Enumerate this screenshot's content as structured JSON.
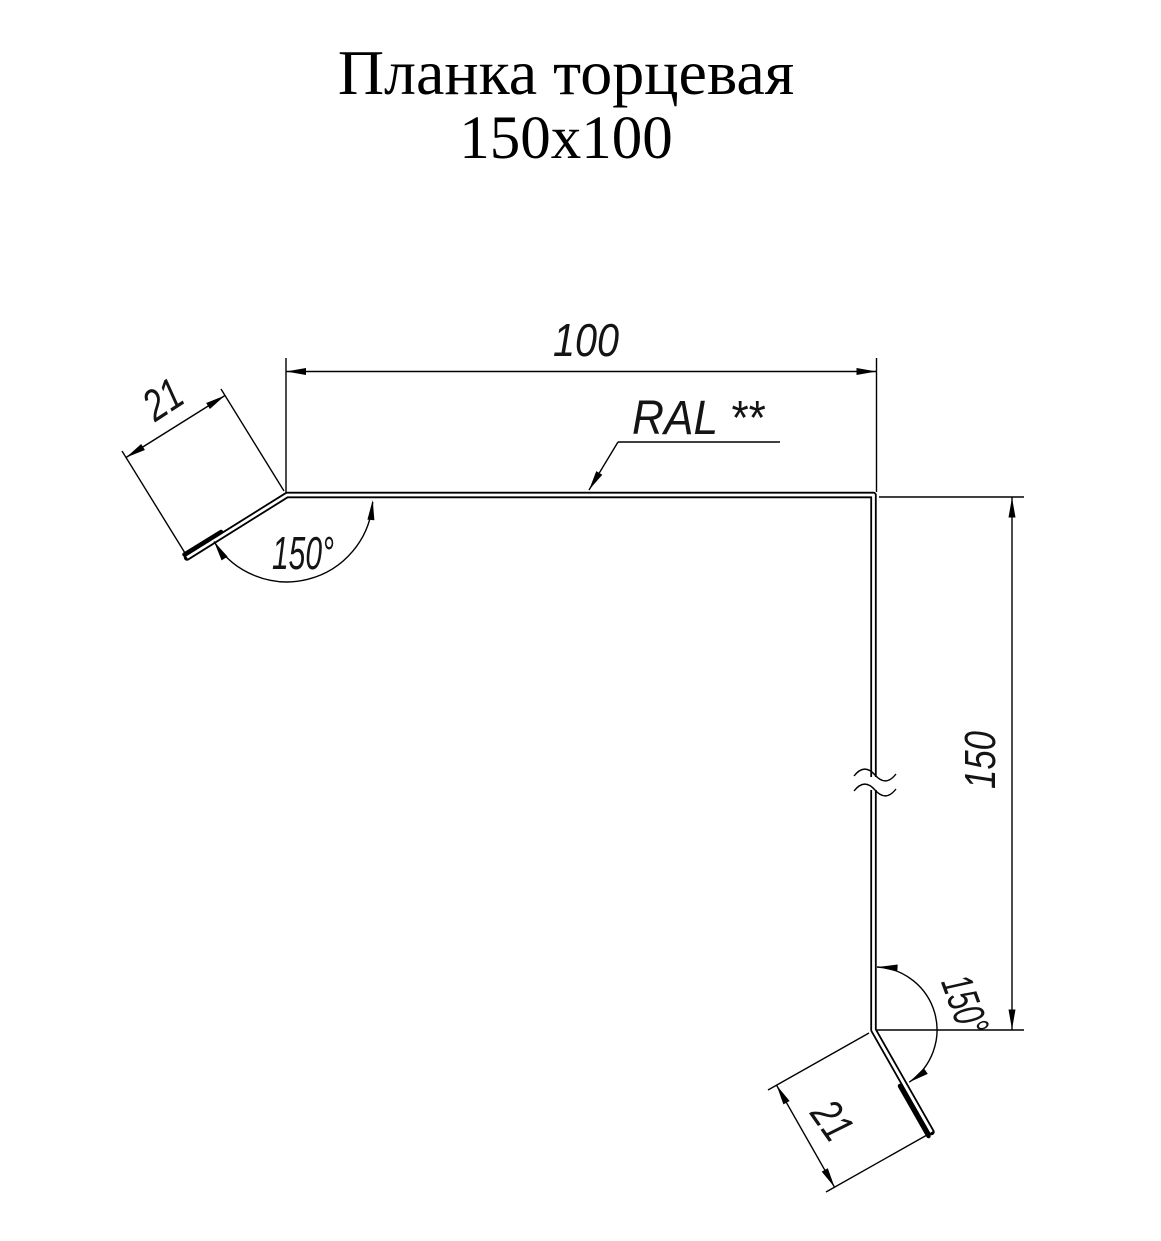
{
  "title": {
    "line1": "Планка торцевая",
    "line2": "150x100"
  },
  "annotations": {
    "coating_label": "RAL **"
  },
  "dimensions": {
    "top_width": "100",
    "top_flange_width": "21",
    "top_bend_angle": "150°",
    "side_height": "150",
    "bottom_bend_angle": "150°",
    "bottom_flange_width": "21"
  },
  "colors": {
    "line": "#000000",
    "text": "#141414",
    "background": "#ffffff"
  }
}
